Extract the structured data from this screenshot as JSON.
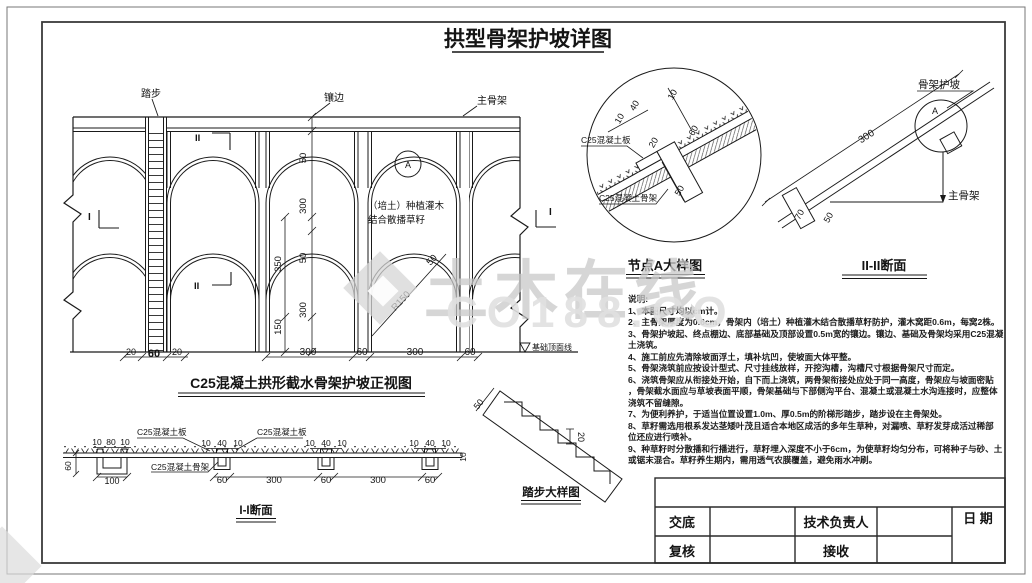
{
  "title": "拱型骨架护坡详图",
  "wm": {
    "brand": "土木在线",
    "url": "CO188.CO"
  },
  "elev": {
    "caption": "C25混凝土拱形截水骨架护坡正视图",
    "steps": "踏步",
    "edging": "镶边",
    "main": "主骨架",
    "plant1": "（培土）种植灌木",
    "plant2": "结合散播草籽",
    "a": "A",
    "i_left": "I",
    "i_right": "I",
    "ii_top": "II",
    "ii_bottom": "II",
    "r150": "R150",
    "ring50": "50",
    "v50a": "50",
    "v300a": "300",
    "v50b": "50",
    "v300b": "300",
    "v350": "350",
    "v150": "150",
    "b20a": "20",
    "b60s": "60",
    "b20b": "20",
    "b300a": "300",
    "b60a": "60",
    "b300b": "300",
    "b60b": "60",
    "found": "基础顶面线"
  },
  "node": {
    "caption": "节点A大样图",
    "slab": "C25混凝土板",
    "frame": "C25混凝土骨架",
    "d10a": "10",
    "d40": "40",
    "d10b": "10",
    "d20": "20",
    "d60": "60",
    "d50": "50"
  },
  "s22": {
    "caption": "II-II断面",
    "slope": "骨架护坡",
    "main": "主骨架",
    "a": "A",
    "d300": "300",
    "d70": "70",
    "d50": "50"
  },
  "s11": {
    "caption": "I-I断面",
    "slab1": "C25混凝土板",
    "slab2": "C25混凝土板",
    "frame": "C25混凝土骨架",
    "t10a": "10",
    "t80": "80",
    "t10b": "10",
    "v60": "60",
    "b100": "100",
    "r2": [
      "10",
      "40",
      "10"
    ],
    "r3": [
      "10",
      "40",
      "10"
    ],
    "r4": [
      "10",
      "40",
      "10"
    ],
    "b60a": "60",
    "b300a": "300",
    "b60b": "60",
    "b300b": "300",
    "b60c": "60",
    "v10": "10"
  },
  "steps": {
    "caption": "踏步大样图",
    "d50": "50",
    "d20": "20"
  },
  "notes": {
    "heading": "说明:",
    "lines": [
      "1、本图尺寸均以cm计。",
      "2、主骨架厚度为0.6cm，骨架内（培土）种植灌木结合散播草籽防护，灌木窝距0.6m，每窝2株。",
      "3、骨架护坡起、终点棚边、底部基础及顶部设置0.5m宽的镶边。镶边、基础及骨架均采用C25混凝",
      "土浇筑。",
      "4、施工前应先清除坡面浮土，填补坑凹，使坡面大体平整。",
      "5、骨架浇筑前应按设计型式、尺寸挂线放样，开挖沟槽，沟槽尺寸根据骨架尺寸而定。",
      "6、浇筑骨架应从衔接处开始，自下而上浇筑，两骨架衔接处应处于同一高度，骨架应与坡面密贴",
      "，骨架截水面应与草坡表面平顺，骨架基础与下部侧沟平台、混凝土或混凝土水沟连接时，应整体",
      "浇筑不留缝隙。",
      "7、为便利养护，于适当位置设置1.0m、厚0.5m的阶梯形踏步，踏步设在主骨架处。",
      "8、草籽需选用根系发达茎矮叶茂且适合本地区成活的多年生草种，对漏喷、草籽发芽成活过稀部",
      "位还应进行喷补。",
      "9、种草籽时分散播和行播进行，草籽埋入深度不小于6cm，为使草籽均匀分布，可将种子与砂、土",
      "或锯末混合。草籽养生期内，需用透气农膜覆盖，避免雨水冲刷。"
    ]
  },
  "tb": {
    "jiaodi": "交底",
    "fuhe": "复核",
    "tech": "技术负责人",
    "jieshou": "接收",
    "date": "日 期"
  }
}
